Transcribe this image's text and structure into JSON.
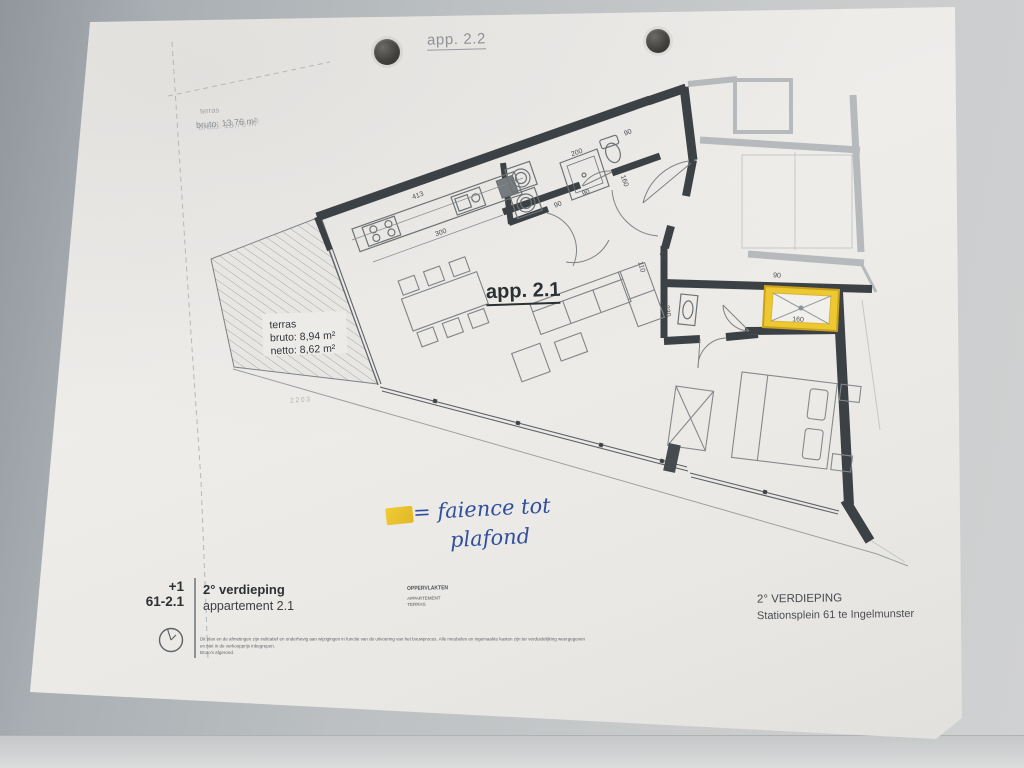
{
  "plan_labels": {
    "app22": "app. 2.2",
    "app21": "app. 2.1",
    "terras_title": "terras",
    "terras_bruto": "bruto: 8,94 m²",
    "terras_netto": "netto: 8,62 m²",
    "faint_terras_title": "terras",
    "faint_terras_area": "bruto: 13,76 m²",
    "street_mark": "2203"
  },
  "handwriting": {
    "line1": "= faience tot",
    "line2": "plafond"
  },
  "title_block": {
    "level_code": "+1",
    "plan_code": "61-2.1",
    "title": "2° verdieping",
    "subtitle": "appartement 2.1",
    "fine_print_1": "Dit plan en de afmetingen zijn indicatief en onderhevig aan wijzigingen in functie van de uitvoering van het bouwproces. Alle meubelen en ingemaakte kasten zijn ter verduidelijking weergegeven en niet in de verkoopprijs inbegrepen.",
    "fine_print_2": "Bruto's afgerond."
  },
  "areas_block": {
    "header": "OPPERVLAKTEN",
    "row1": "APPARTEMENT",
    "row2": "TERRAS"
  },
  "location_block": {
    "title": "2° VERDIEPING",
    "subtitle": "Stationsplein 61 te Ingelmunster"
  },
  "colors": {
    "wall_dark": "#3b4144",
    "wall_light": "#b6babc",
    "highlight_yellow": "#eec830",
    "ink_blue": "#2f4f9e",
    "paper": "#ecebe8"
  },
  "dimensions": [
    {
      "t": "413",
      "x": 418,
      "y": 196,
      "r": -20
    },
    {
      "t": "300",
      "x": 441,
      "y": 233,
      "r": -20
    },
    {
      "t": "200",
      "x": 577,
      "y": 153,
      "r": -20
    },
    {
      "t": "90",
      "x": 628,
      "y": 133,
      "r": -20
    },
    {
      "t": "90",
      "x": 586,
      "y": 193,
      "r": -20
    },
    {
      "t": "90",
      "x": 558,
      "y": 205,
      "r": -20
    },
    {
      "t": "160",
      "x": 624,
      "y": 181,
      "r": 70
    },
    {
      "t": "110",
      "x": 641,
      "y": 267,
      "r": 75
    },
    {
      "t": "62",
      "x": 662,
      "y": 256,
      "r": 75
    },
    {
      "t": "230",
      "x": 667,
      "y": 311,
      "r": 80
    },
    {
      "t": "90",
      "x": 777,
      "y": 276,
      "r": 3
    },
    {
      "t": "160",
      "x": 798,
      "y": 320,
      "r": 3
    },
    {
      "t": "41",
      "x": 673,
      "y": 460,
      "r": 75
    }
  ]
}
